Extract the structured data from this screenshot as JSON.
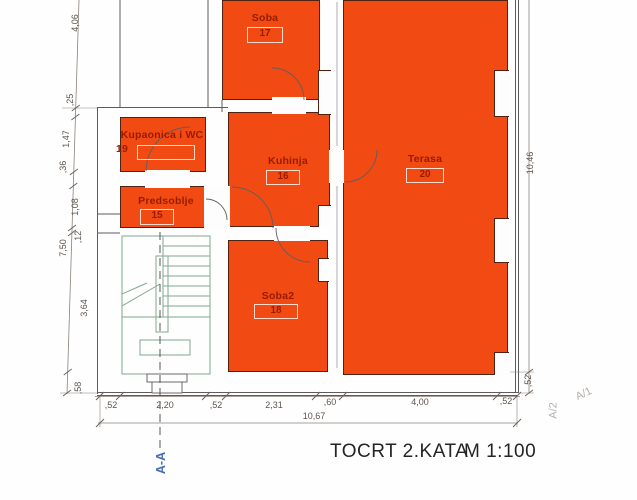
{
  "title": {
    "text": "TOCRT 2.KATA",
    "scale": "M 1:100"
  },
  "section_label": "A-A",
  "rooms": [
    {
      "name": "Soba",
      "number": "17"
    },
    {
      "name": "Kupaonica i WC",
      "number": "19"
    },
    {
      "name": "Kuhinja",
      "number": "16"
    },
    {
      "name": "Terasa",
      "number": "20"
    },
    {
      "name": "Predsoblje",
      "number": "15"
    },
    {
      "name": "Soba2",
      "number": "18"
    }
  ],
  "dimensions": {
    "left_outer": [
      "4,06",
      "7,50"
    ],
    "left_inner": [
      ",25",
      "1,47",
      ",36",
      "1,08",
      ",12",
      "3,64",
      ",58"
    ],
    "bottom": [
      ",52",
      "2,20",
      ",52",
      "2,31",
      ",60",
      "4,00",
      ",52"
    ],
    "bottom_total": "10,67",
    "right_height": "10,46",
    "right_bottom": ",52",
    "axis_labels": [
      "A/1",
      "A/2"
    ]
  },
  "colors": {
    "room_fill": "#f14a12",
    "room_text": "#9a1c00",
    "section_text": "#4a6fae",
    "axis_text": "#b5afab"
  }
}
